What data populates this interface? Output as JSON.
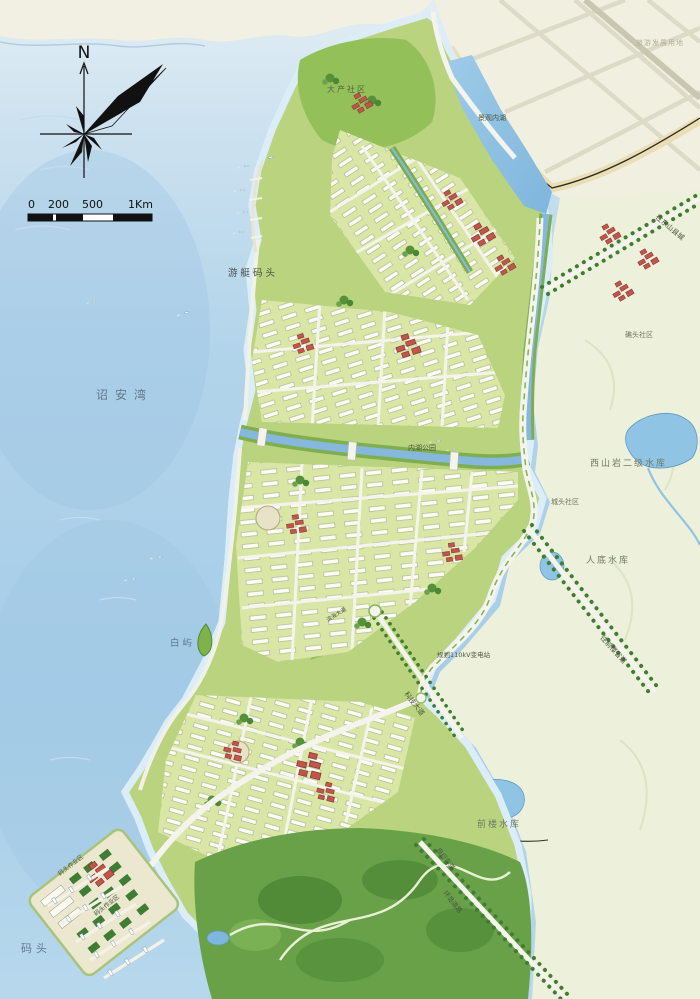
{
  "map_labels": {
    "bay": "诏安湾",
    "marina": "游艇码头",
    "white_islet": "白屿",
    "wharf": "码头",
    "landscape_lake": "景观内湖",
    "inner_lake_park": "内湖公园",
    "dachan_community": "大产社区",
    "jiaotou_community": "礁头社区",
    "chengtou_community": "城头社区",
    "xishanyan_reservoir": "西山岩二级水库",
    "rendi_reservoir": "人底水库",
    "qianlou_reservoir": "前楼水库",
    "substation": "规划110kV变电站",
    "to_dongshan": "往东山县城",
    "to_qianlou": "往前楼省道",
    "keji_avenue": "科技大道",
    "binhai_avenue": "滨海大道",
    "bike_lane": "自行车道",
    "ring_road": "环岛道路",
    "dock_area_1": "码头作业区",
    "dock_area_2": "码头作业区",
    "tourism_land": "旅游发展用地"
  },
  "compass": {
    "north": "N"
  },
  "scale_bar": {
    "ticks": [
      "0",
      "200",
      "500",
      "1Km"
    ]
  },
  "palette": {
    "water": "#a8cfe9",
    "shallow_water": "#cfe4f3",
    "land_cream": "#f1efe0",
    "east_hills": "#edf0db",
    "urban_block": "#d9e6a6",
    "park_green": "#8cbb55",
    "forest_green": "#69a149",
    "building_white": "#fcfcf5",
    "building_red": "#c2544b",
    "road_white": "#f4f4ec",
    "reservoir_blue": "#8fc4e4",
    "compass_black": "#111111"
  }
}
